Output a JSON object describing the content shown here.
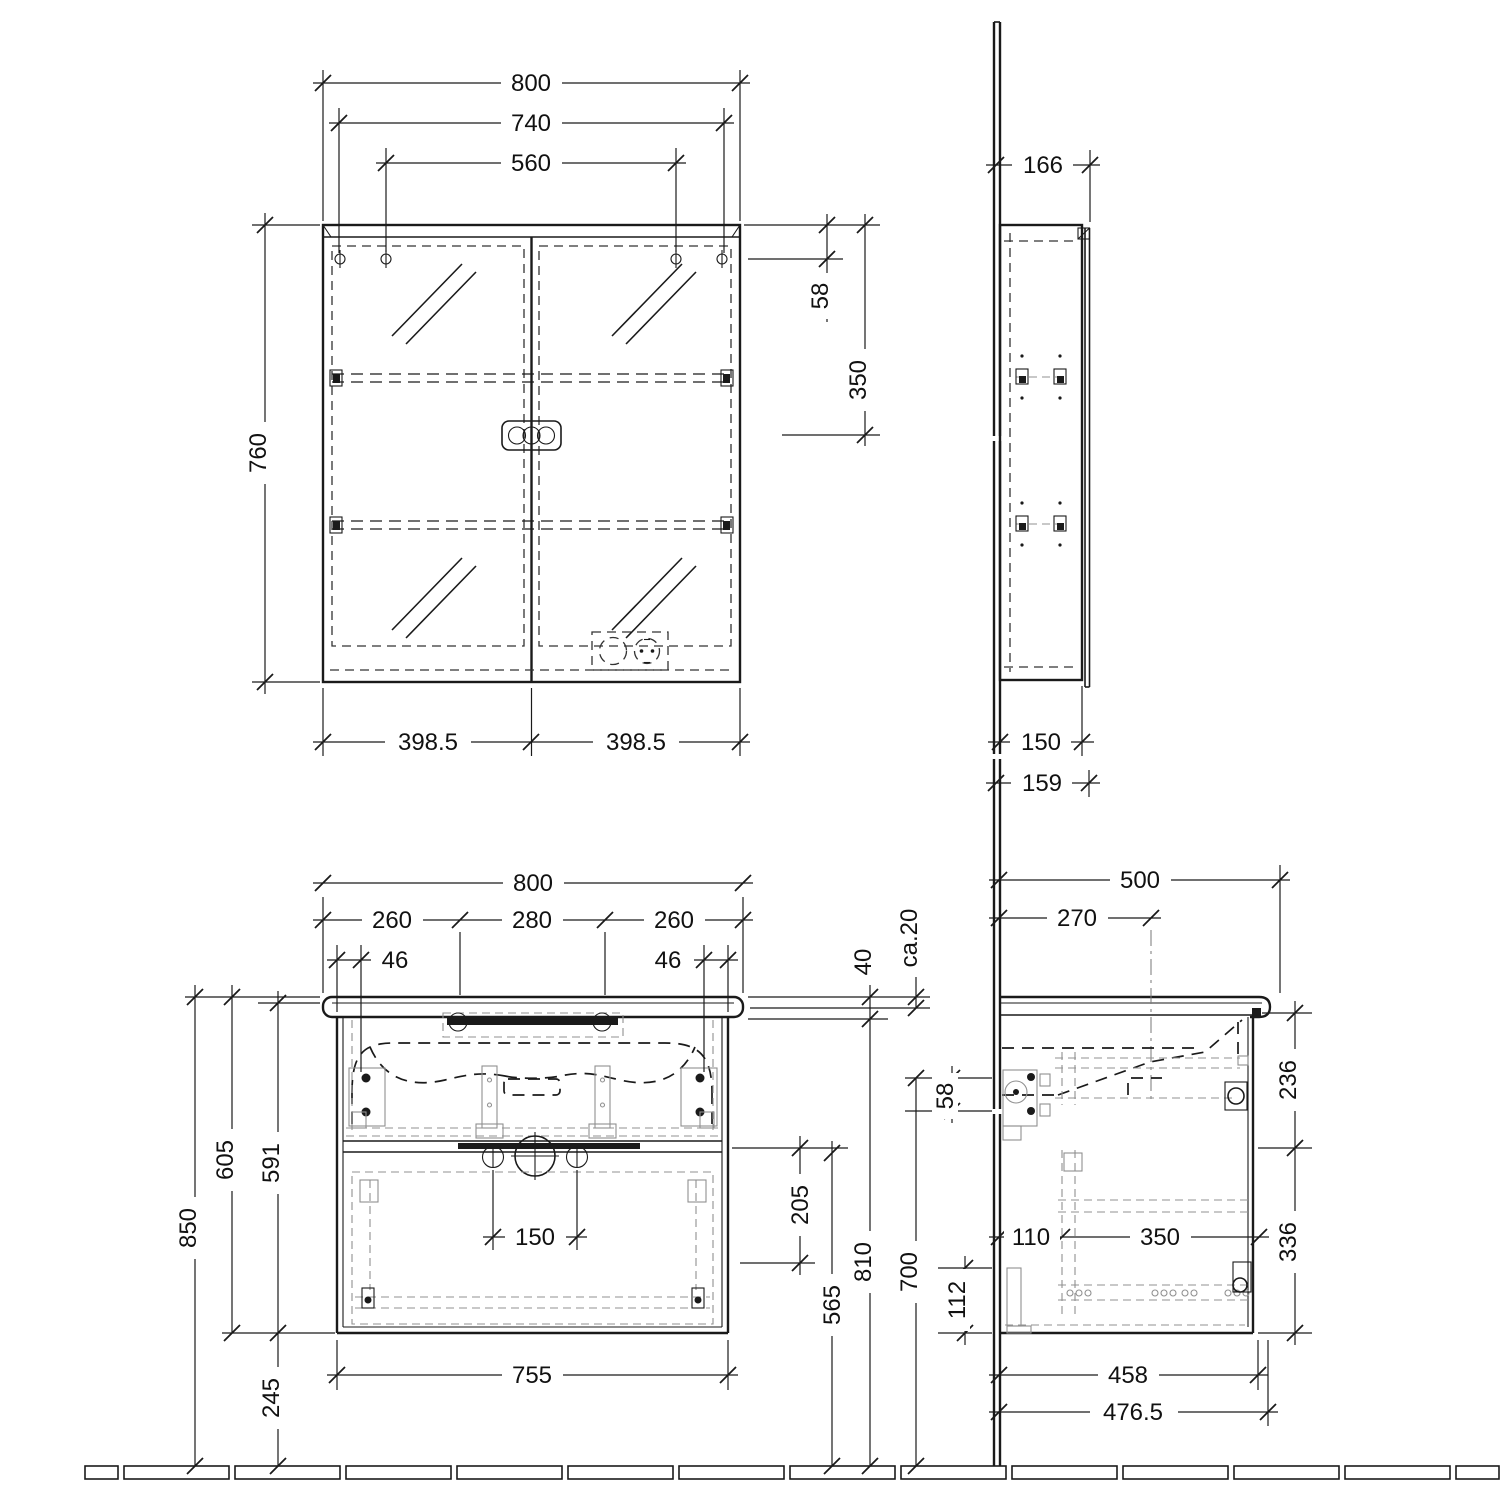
{
  "drawing": {
    "kind": "bathroom furniture installation drawing",
    "views": [
      "mirror-cabinet-front",
      "mirror-cabinet-side",
      "vanity-unit-front",
      "vanity-unit-side"
    ],
    "colors": {
      "line": "#1a1a1a",
      "detail_gray": "#909090",
      "background": "#ffffff"
    }
  },
  "dims": {
    "mf_800": "800",
    "mf_740": "740",
    "mf_560": "560",
    "mf_760": "760",
    "mf_58": "58",
    "mf_350": "350",
    "mf_3985_l": "398.5",
    "mf_3985_r": "398.5",
    "ms_166": "166",
    "ms_150": "150",
    "ms_159": "159",
    "vf_800": "800",
    "vf_260l": "260",
    "vf_280": "280",
    "vf_260r": "260",
    "vf_46l": "46",
    "vf_46r": "46",
    "vf_40": "40",
    "vf_ca20": "ca.20",
    "vf_58": "58",
    "vf_850": "850",
    "vf_605": "605",
    "vf_591": "591",
    "vf_245": "245",
    "vf_150": "150",
    "vf_205": "205",
    "vf_565": "565",
    "vf_810": "810",
    "vf_700": "700",
    "vf_755": "755",
    "vs_500": "500",
    "vs_270": "270",
    "vs_236": "236",
    "vs_336": "336",
    "vs_110": "110",
    "vs_350": "350",
    "vs_112": "112",
    "vs_458": "458",
    "vs_4765": "476.5"
  }
}
